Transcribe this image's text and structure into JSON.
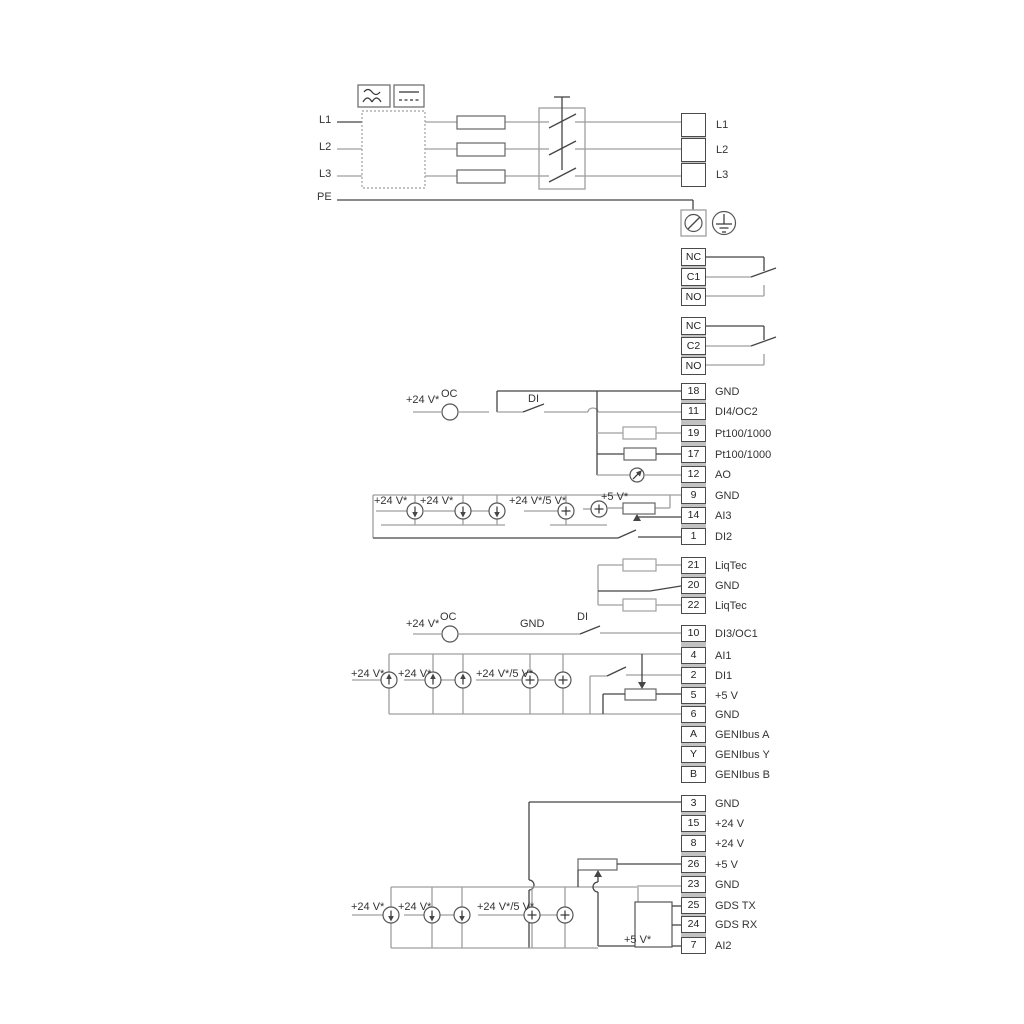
{
  "diagram": {
    "type": "pump-drive-wiring-diagram",
    "colors": {
      "wire_gray": "#9f9f9f",
      "wire_dark": "#454545",
      "text": "#333333",
      "cell_border": "#4a4a4a",
      "block_separator": "#c2c2c2"
    },
    "annotations": [
      {
        "text": "L1"
      },
      {
        "text": "L2"
      },
      {
        "text": "L3"
      },
      {
        "text": "PE"
      },
      {
        "text": "+24 V*"
      },
      {
        "text": "OC"
      },
      {
        "text": "DI"
      },
      {
        "text": "+24 V*"
      },
      {
        "text": "+24 V*"
      },
      {
        "text": "+24 V*/5 V*"
      },
      {
        "text": "+5 V*"
      },
      {
        "text": "+24 V*"
      },
      {
        "text": "OC"
      },
      {
        "text": "GND"
      },
      {
        "text": "DI"
      },
      {
        "text": "+24 V*"
      },
      {
        "text": "+24 V*"
      },
      {
        "text": "+24 V*/5 V*"
      },
      {
        "text": "+24 V*"
      },
      {
        "text": "+24 V*"
      },
      {
        "text": "+24 V*/5 V*"
      },
      {
        "text": "+5 V*"
      }
    ],
    "terminal_blocks": [
      {
        "id": "mains",
        "cells": [
          {
            "num": "",
            "label": "L1"
          },
          {
            "num": "",
            "label": "L2"
          },
          {
            "num": "",
            "label": "L3"
          }
        ]
      },
      {
        "id": "relay1",
        "cells": [
          {
            "num": "NC",
            "label": ""
          },
          {
            "num": "C1",
            "label": ""
          },
          {
            "num": "NO",
            "label": ""
          }
        ]
      },
      {
        "id": "relay2",
        "cells": [
          {
            "num": "NC",
            "label": ""
          },
          {
            "num": "C2",
            "label": ""
          },
          {
            "num": "NO",
            "label": ""
          }
        ]
      },
      {
        "id": "io1",
        "cells": [
          {
            "num": "18",
            "label": "GND"
          },
          {
            "num": "11",
            "label": "DI4/OC2"
          },
          {
            "num": "19",
            "label": "Pt100/1000"
          },
          {
            "num": "17",
            "label": "Pt100/1000"
          },
          {
            "num": "12",
            "label": "AO"
          },
          {
            "num": "9",
            "label": "GND"
          },
          {
            "num": "14",
            "label": "AI3"
          },
          {
            "num": "1",
            "label": "DI2"
          }
        ]
      },
      {
        "id": "liqtec",
        "cells": [
          {
            "num": "21",
            "label": "LiqTec"
          },
          {
            "num": "20",
            "label": "GND"
          },
          {
            "num": "22",
            "label": "LiqTec"
          }
        ]
      },
      {
        "id": "io2",
        "cells": [
          {
            "num": "10",
            "label": "DI3/OC1"
          },
          {
            "num": "4",
            "label": "AI1"
          },
          {
            "num": "2",
            "label": "DI1"
          },
          {
            "num": "5",
            "label": "+5 V"
          },
          {
            "num": "6",
            "label": "GND"
          },
          {
            "num": "A",
            "label": "GENIbus A"
          },
          {
            "num": "Y",
            "label": "GENIbus Y"
          },
          {
            "num": "B",
            "label": "GENIbus B"
          }
        ]
      },
      {
        "id": "io3",
        "cells": [
          {
            "num": "3",
            "label": "GND"
          },
          {
            "num": "15",
            "label": "+24 V"
          },
          {
            "num": "8",
            "label": "+24 V"
          },
          {
            "num": "26",
            "label": "+5 V"
          },
          {
            "num": "23",
            "label": "GND"
          },
          {
            "num": "25",
            "label": "GDS TX"
          },
          {
            "num": "24",
            "label": "GDS RX"
          },
          {
            "num": "7",
            "label": "AI2"
          }
        ]
      }
    ]
  }
}
